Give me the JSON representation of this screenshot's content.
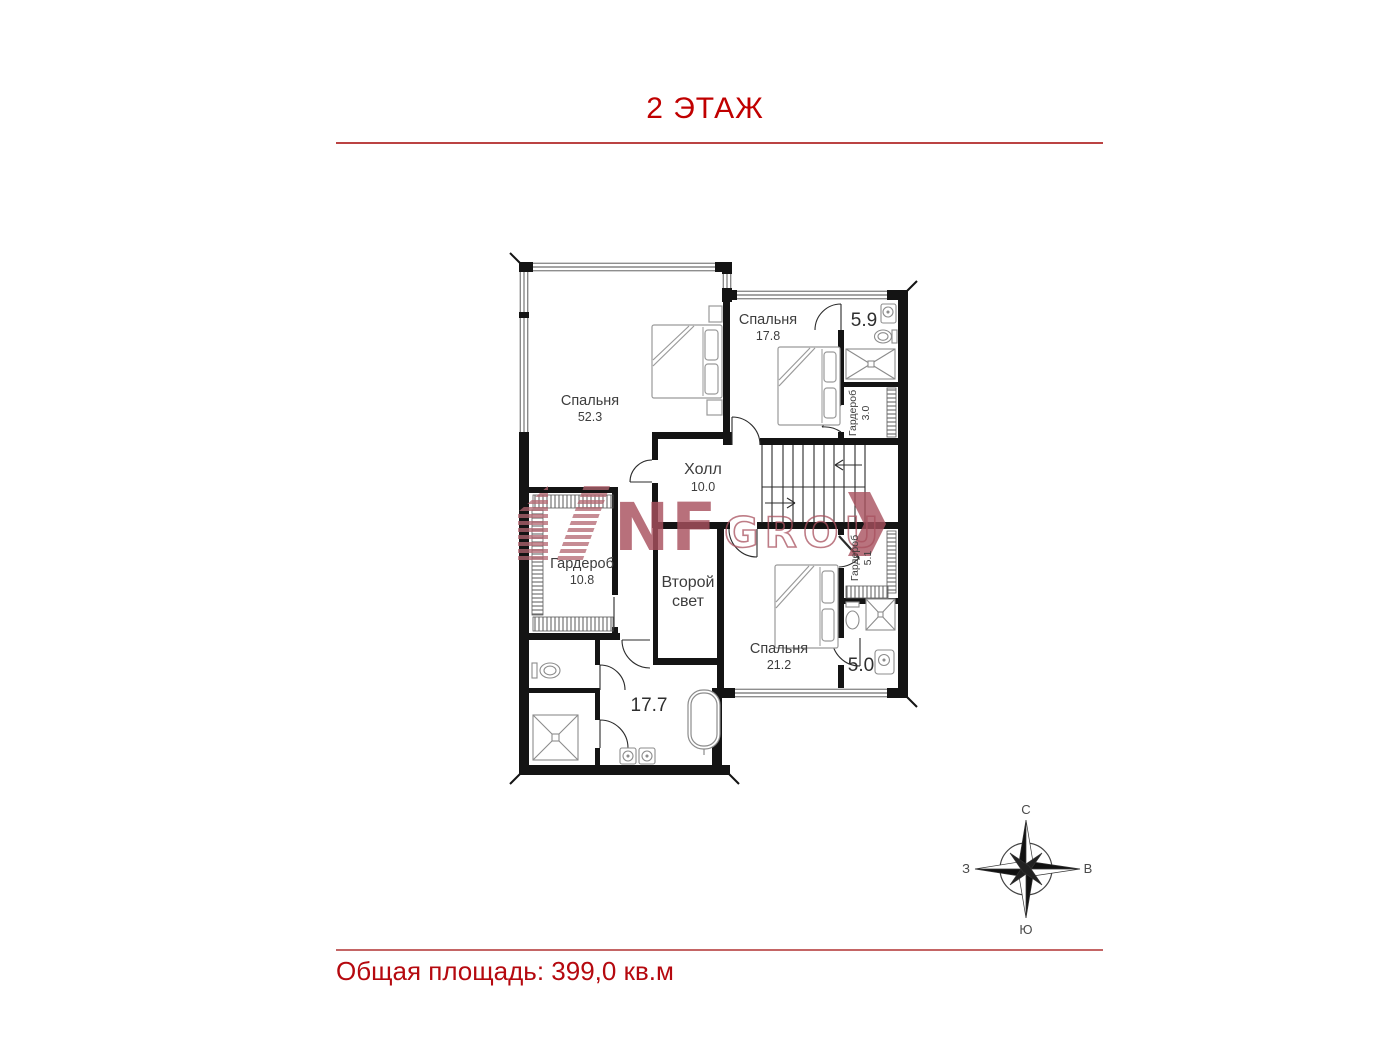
{
  "header": {
    "title": "2 ЭТАЖ"
  },
  "footer": {
    "total_area": "Общая площадь: 399,0 кв.м"
  },
  "watermark": {
    "brand": "NF",
    "suffix": "GROUP"
  },
  "compass": {
    "north": "С",
    "south": "Ю",
    "west": "З",
    "east": "В"
  },
  "rooms": [
    {
      "name": "Спальня",
      "area": "52.3"
    },
    {
      "name": "Спальня",
      "area": "17.8"
    },
    {
      "name": "",
      "area": "5.9"
    },
    {
      "name": "Гардероб",
      "area": "3.0"
    },
    {
      "name": "Холл",
      "area": "10.0"
    },
    {
      "name": "Гардероб",
      "area": "10.8"
    },
    {
      "name": "Второй свет",
      "area": ""
    },
    {
      "name": "Гардероб",
      "area": "5.1"
    },
    {
      "name": "Спальня",
      "area": "21.2"
    },
    {
      "name": "",
      "area": "5.0"
    },
    {
      "name": "",
      "area": "17.7"
    }
  ]
}
